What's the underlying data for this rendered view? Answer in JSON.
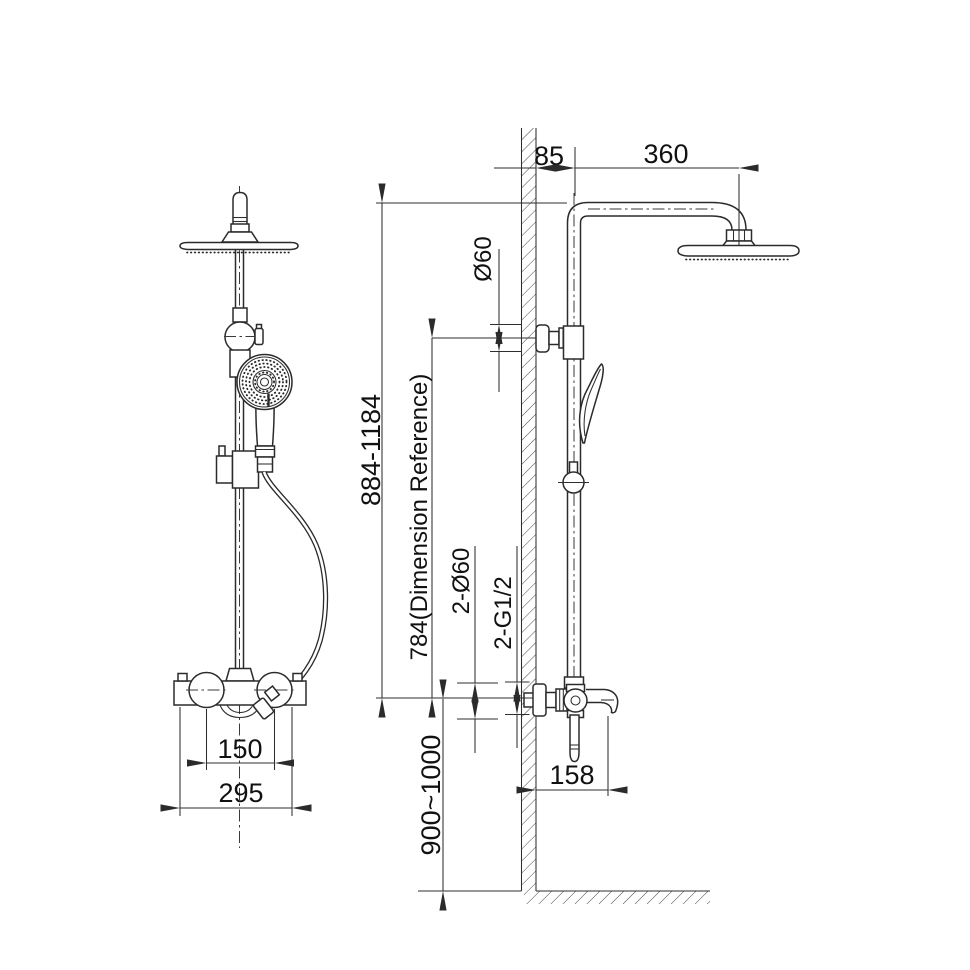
{
  "colors": {
    "background": "#ffffff",
    "line": "#2b2b2b",
    "text": "#111111"
  },
  "dimensions": {
    "arm_wall_offset": "85",
    "arm_length": "360",
    "wall_bracket_diameter": "Ø60",
    "column_height_range": "884-1184",
    "reference_height": "784(Dimension Reference)",
    "inlet_flange_diameter": "2-Ø60",
    "inlet_thread_size": "2-G1/2",
    "valve_install_height": "900~1000",
    "spout_projection": "158",
    "inlet_center_spacing": "150",
    "valve_body_width": "295"
  }
}
